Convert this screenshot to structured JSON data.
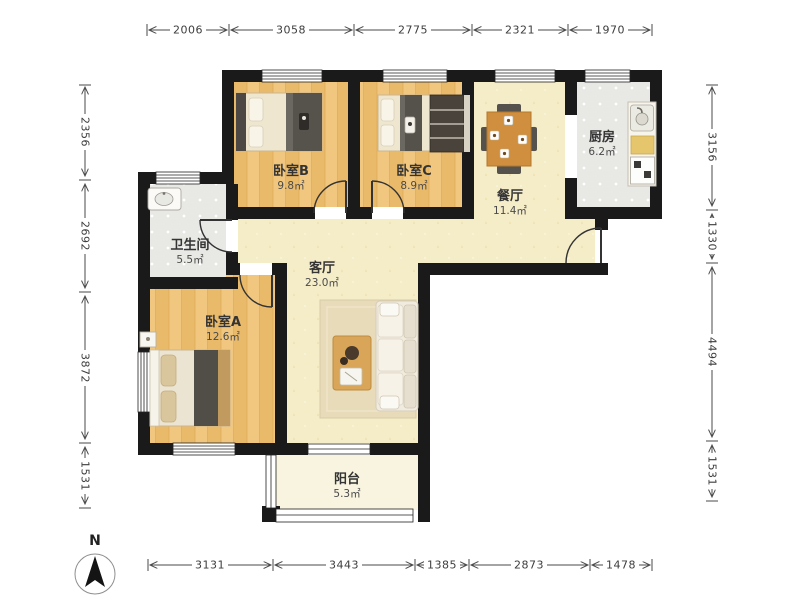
{
  "rooms": [
    {
      "name": "卧室B",
      "area": "9.8㎡"
    },
    {
      "name": "卧室C",
      "area": "8.9㎡"
    },
    {
      "name": "餐厅",
      "area": "11.4㎡"
    },
    {
      "name": "厨房",
      "area": "6.2㎡"
    },
    {
      "name": "卫生间",
      "area": "5.5㎡"
    },
    {
      "name": "客厅",
      "area": "23.0㎡"
    },
    {
      "name": "卧室A",
      "area": "12.6㎡"
    },
    {
      "name": "阳台",
      "area": "5.3㎡"
    }
  ],
  "dimensions": {
    "top": [
      "2006",
      "3058",
      "2775",
      "2321",
      "1970"
    ],
    "bottom": [
      "3131",
      "3443",
      "1385",
      "2873",
      "1478"
    ],
    "left": [
      "2356",
      "2692",
      "3872",
      "1531"
    ],
    "right": [
      "3156",
      "1330",
      "4494",
      "1531"
    ]
  },
  "compass": {
    "north_label": "N"
  },
  "colors": {
    "wall": "#1a1a1a",
    "wood_floor": "#f0c67e",
    "public_floor": "#f5ecc8",
    "tile_floor": "#e8e8e5",
    "balcony_floor": "#f8f4e0",
    "table_wood": "#cf8f3e"
  }
}
